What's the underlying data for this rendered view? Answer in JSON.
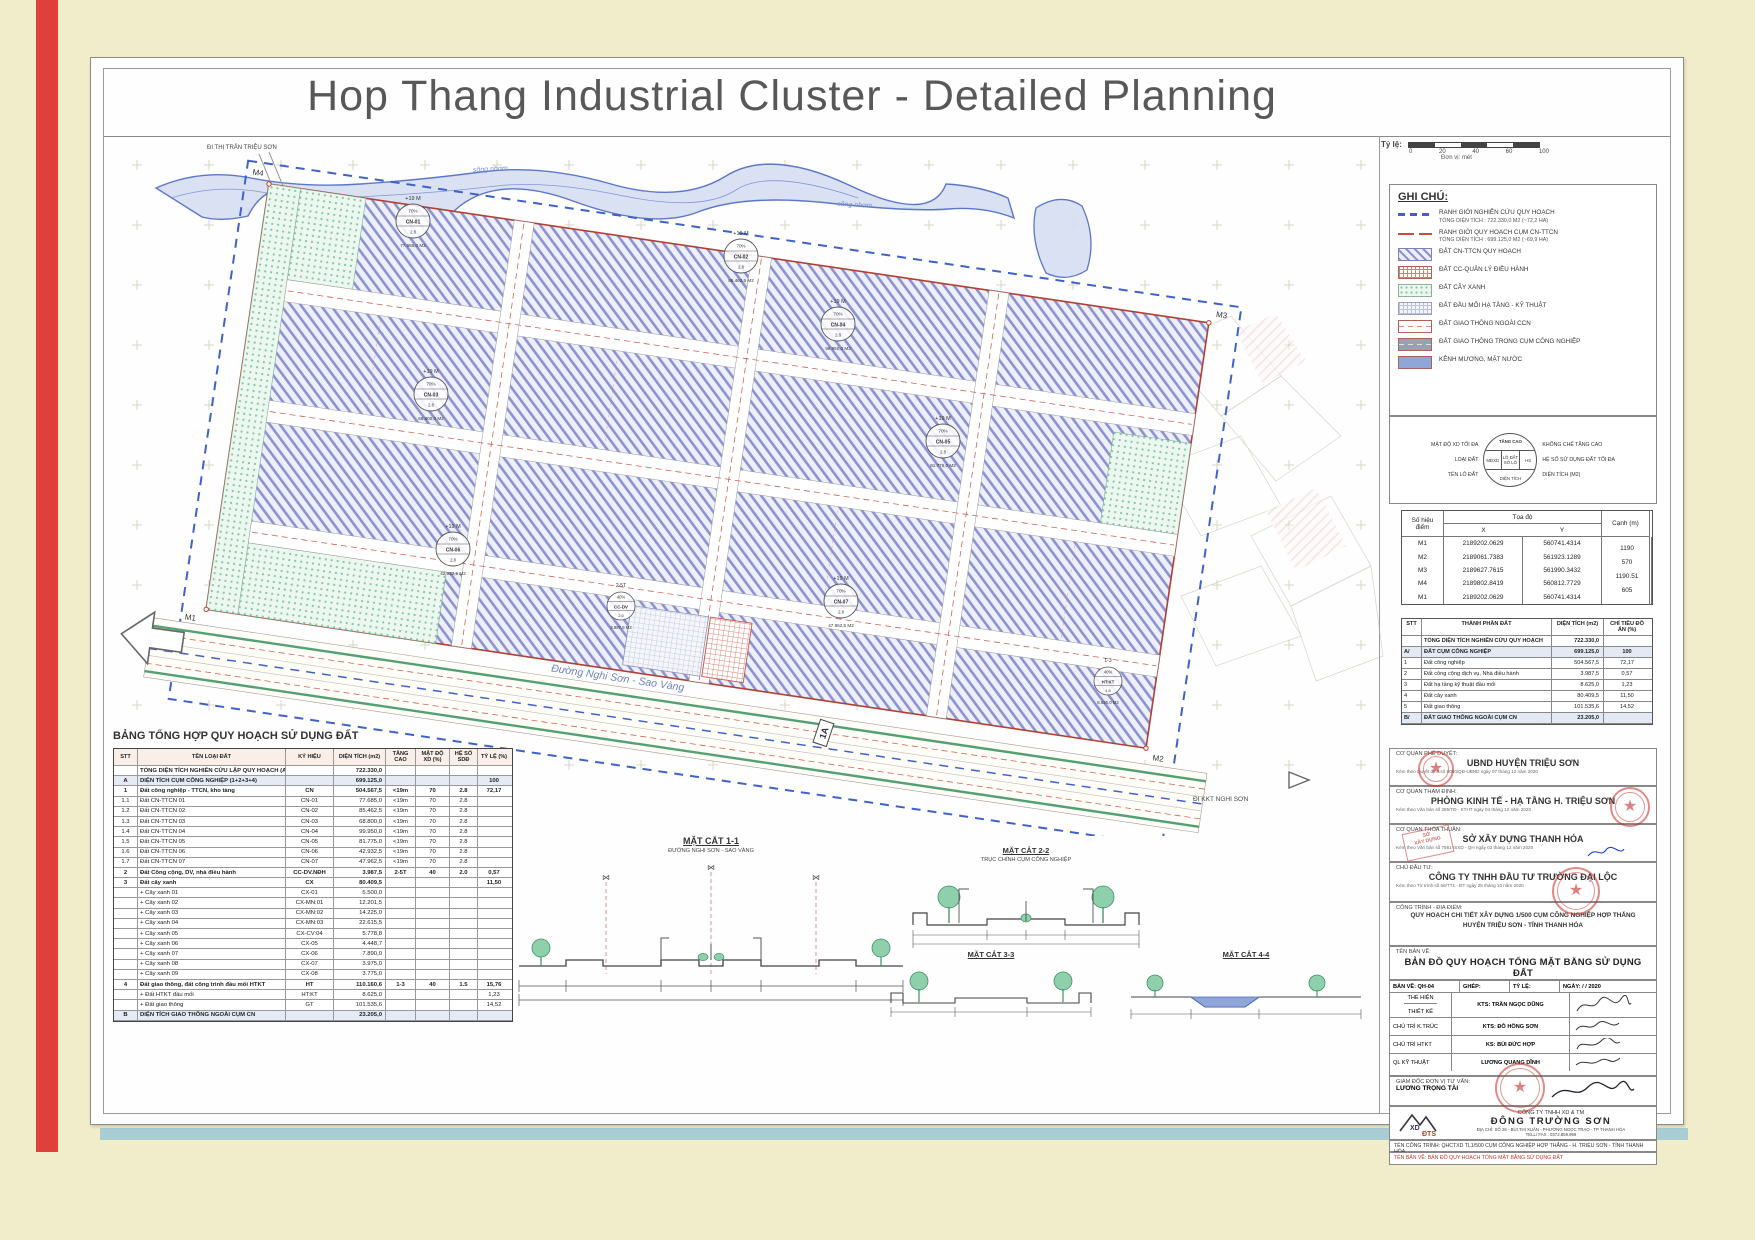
{
  "page": {
    "title": "Hop Thang Industrial Cluster - Detailed Planning"
  },
  "scalebar": {
    "label": "Tỷ lệ:",
    "ticks": [
      "0",
      "20",
      "40",
      "60",
      "100"
    ],
    "unit": "Đơn vị: mét"
  },
  "map": {
    "dir_top_left": "ĐI THỊ TRẤN TRIỆU SƠN",
    "dir_bottom_right": "ĐI KKT NGHI SƠN",
    "river_labels": [
      "sông nhơm",
      "sông nhơm"
    ],
    "road_label": "Đường Nghi Sơn - Sao Vàng",
    "marker_1a": "1A",
    "corners": [
      "M4",
      "M3",
      "M2",
      "M1"
    ],
    "lots": [
      {
        "code": "CN-01",
        "height": "+19 M",
        "density": "70%",
        "far": "2.8",
        "area": "77.685,0 M2"
      },
      {
        "code": "CN-02",
        "height": "+19 M",
        "density": "70%",
        "far": "2.8",
        "area": "85.462,5 M2"
      },
      {
        "code": "CN-03",
        "height": "+19 M",
        "density": "70%",
        "far": "2.8",
        "area": "68.800,0 M2"
      },
      {
        "code": "CN-04",
        "height": "+19 M",
        "density": "70%",
        "far": "2.8",
        "area": "99.950,0 M2"
      },
      {
        "code": "CN-05",
        "height": "+19 M",
        "density": "70%",
        "far": "2.8",
        "area": "81.775,0 M2"
      },
      {
        "code": "CN-06",
        "height": "+19 M",
        "density": "70%",
        "far": "2.8",
        "area": "42.932,5 M2"
      },
      {
        "code": "CN-07",
        "height": "+19 M",
        "density": "70%",
        "far": "2.8",
        "area": "47.962,5 M2"
      },
      {
        "code": "CC-DV",
        "height": "2-5T",
        "density": "40%",
        "far": "2.0",
        "area": "3.987,5 M2"
      },
      {
        "code": "HT:KT",
        "height": "1-3",
        "density": "40%",
        "far": "1.5",
        "area": "8.625,0 M2"
      }
    ]
  },
  "legend": {
    "title": "GHI CHÚ:",
    "items": [
      {
        "swatch": "boundary-blue",
        "label": "RANH GIỚI NGHIÊN CỨU QUY HOẠCH",
        "sub": "TỔNG DIỆN TÍCH :  722.330,0 M2 (~72,2 HA)"
      },
      {
        "swatch": "boundary-red",
        "label": "RANH GIỚI QUY HOẠCH CỤM CN-TTCN",
        "sub": "TỔNG DIỆN TÍCH :  699.125,0 M2 (~69,9 HA)"
      },
      {
        "swatch": "hatch-purple",
        "label": "ĐẤT CN-TTCN QUY HOẠCH",
        "sub": ""
      },
      {
        "swatch": "grid-red",
        "label": "ĐẤT CC-QUẢN LÝ ĐIỀU HÀNH",
        "sub": ""
      },
      {
        "swatch": "dots-green",
        "label": "ĐẤT CÂY XANH",
        "sub": ""
      },
      {
        "swatch": "grid-gray",
        "label": "ĐẤT ĐẦU MỐI HẠ TẦNG - KỸ THUẬT",
        "sub": ""
      },
      {
        "swatch": "road-outer",
        "label": "ĐẤT GIAO THÔNG NGOÀI CCN",
        "sub": ""
      },
      {
        "swatch": "road-inner",
        "label": "ĐẤT GIAO THÔNG TRONG CỤM CÔNG NGHIỆP",
        "sub": ""
      },
      {
        "swatch": "water",
        "label": "KÊNH MƯƠNG, MẶT NƯỚC",
        "sub": ""
      }
    ]
  },
  "symbol_key": {
    "left_labels": [
      "MẬT ĐỘ XD TỐI ĐA",
      "LOẠI ĐẤT",
      "TÊN LÔ ĐẤT"
    ],
    "right_labels": [
      "KHỐNG CHẾ TẦNG CAO",
      "HỆ SỐ SỬ DỤNG ĐẤT TỐI ĐA",
      "DIỆN TÍCH (M2)"
    ],
    "circle": {
      "top": "TẦNG CAO",
      "c1": "MĐXD",
      "c2": "LÔ ĐẤT SỐ LÔ",
      "c3": "HS",
      "bottom": "DIỆN TÍCH"
    }
  },
  "coords_table": {
    "h_point": "Số hiệu điểm",
    "h_coord": "Tọa độ",
    "h_x": "X",
    "h_y": "Y",
    "h_edge": "Cạnh (m)",
    "rows": [
      {
        "p": "M1",
        "x": "2189202.0629",
        "y": "560741.4314"
      },
      {
        "p": "M2",
        "x": "2189061.7383",
        "y": "561923.1289"
      },
      {
        "p": "M3",
        "x": "2189627.7615",
        "y": "561990.3432"
      },
      {
        "p": "M4",
        "x": "2189802.8419",
        "y": "560812.7729"
      },
      {
        "p": "M1",
        "x": "2189202.0629",
        "y": "560741.4314"
      }
    ],
    "edges": [
      "1190",
      "570",
      "1190.51",
      "605"
    ]
  },
  "composition_table": {
    "headers": {
      "stt": "STT",
      "name": "THÀNH PHẦN ĐẤT",
      "area": "DIỆN TÍCH (m2)",
      "ratio": "CHỈ TIÊU ĐỒ ÁN (%)"
    },
    "rows": [
      {
        "stt": "",
        "name": "TỔNG DIỆN TÍCH NGHIÊN CỨU QUY HOẠCH",
        "area": "722.330,0",
        "ratio": "",
        "variant": "total"
      },
      {
        "stt": "A/",
        "name": "ĐẤT CỤM CÔNG NGHIỆP",
        "area": "699.125,0",
        "ratio": "100",
        "variant": "section"
      },
      {
        "stt": "1",
        "name": "Đất công nghiệp",
        "area": "504.567,5",
        "ratio": "72,17",
        "variant": "sub"
      },
      {
        "stt": "2",
        "name": "Đất công cộng dịch vụ, Nhà điều hành",
        "area": "3.987,5",
        "ratio": "0,57",
        "variant": "sub"
      },
      {
        "stt": "3",
        "name": "Đất hạ tầng kỹ thuật đầu mối",
        "area": "8.625,0",
        "ratio": "1,23",
        "variant": "sub"
      },
      {
        "stt": "4",
        "name": "Đất cây xanh",
        "area": "80.409,5",
        "ratio": "11,50",
        "variant": "sub"
      },
      {
        "stt": "5",
        "name": "Đất giao thông",
        "area": "101.535,6",
        "ratio": "14,52",
        "variant": "sub"
      },
      {
        "stt": "B/",
        "name": "ĐẤT GIAO THÔNG NGOÀI CỤM CN",
        "area": "23.205,0",
        "ratio": "",
        "variant": "section"
      }
    ]
  },
  "approvals": [
    {
      "heading": "CƠ QUAN PHÊ DUYỆT:",
      "name": "UBND HUYỆN TRIỆU SƠN",
      "note": "Kèm theo Quyết định số  8050/QĐ-UBND   ngày 07 tháng 12 năm 2020"
    },
    {
      "heading": "CƠ QUAN THẨM ĐỊNH:",
      "name": "PHÒNG KINH TẾ - HẠ TẦNG H. TRIỆU SƠN",
      "note": "Kèm theo Văn bản số  285/TĐ - KTHT    ngày 04 tháng 12 năm 2020"
    },
    {
      "heading": "CƠ QUAN THỎA THUẬN:",
      "name": "SỞ XÂY DỰNG THANH HÓA",
      "note": "Kèm theo Văn bản số  7561 /SXD - QH    ngày 02 tháng 12 năm 2020"
    },
    {
      "heading": "CHỦ ĐẦU TƯ:",
      "name": "CÔNG TY TNHH ĐẦU TƯ TRƯỜNG ĐẠI LỘC",
      "note": "Kèm theo Tờ trình số  68/TT1 - ĐT   ngày 25 tháng 10 năm 2020"
    }
  ],
  "project": {
    "heading": "CÔNG TRÌNH - ĐỊA ĐIỂM:",
    "line1": "QUY HOẠCH CHI TIẾT XÂY DỰNG 1/500 CỤM CÔNG NGHIỆP HỢP THẮNG",
    "line2": "HUYỆN TRIỆU SƠN - TỈNH THANH HÓA",
    "drawing_heading": "TÊN BẢN VẼ:",
    "drawing_name": "BẢN ĐỒ QUY HOẠCH TỔNG MẶT BẰNG SỬ DỤNG ĐẤT"
  },
  "title_block": {
    "c1": "BẢN VẼ: QH-04",
    "c2": "GHÉP:",
    "c3": "TỶ LỆ:",
    "c4": "NGÀY:     /     / 2020",
    "role1a": "THỂ HIỆN",
    "role1b": "THIẾT KẾ",
    "name1": "KTS: TRẦN NGỌC DŨNG",
    "role2": "CHỦ TRÌ K.TRÚC",
    "name2": "KTS: ĐỖ HỒNG SƠN",
    "role3": "CHỦ TRÌ HTKT",
    "name3": "KS: BÙI ĐỨC HỢP",
    "role4": "QL KỸ THUẬT",
    "name4": "LƯƠNG QUANG DĨNH",
    "director_role": "GIÁM ĐỐC ĐƠN VỊ TƯ VẤN:",
    "director_name": "LƯƠNG TRỌNG TÀI"
  },
  "company": {
    "logo_text1": "XD",
    "logo_text2": "ĐTS",
    "line1": "CÔNG TY TNHH XD & TM",
    "name": "ĐÔNG TRƯỜNG SƠN",
    "address": "ĐỊA CHỈ: SỐ 26 - BÙI THỊ XUÂN - PHƯỜNG NGỌC TRẠO - TP THANH HÓA",
    "phone": "TELL/ FAX : 0372.859.959"
  },
  "footer": {
    "line1": "TÊN CÔNG TRÌNH:  QHCTXD TL1/500 CỤM CÔNG NGHIỆP HỢP THẮNG - H. TRIỆU SƠN - TỈNH THANH HÓA",
    "line2": "TÊN BẢN VẼ:  BẢN ĐỒ QUY HOẠCH TỔNG MẶT BẰNG SỬ DỤNG ĐẤT"
  },
  "landuse_table": {
    "title": "BẢNG TỔNG HỢP QUY HOẠCH SỬ DỤNG ĐẤT",
    "headers": {
      "stt": "STT",
      "name": "TÊN LOẠI ĐẤT",
      "sym": "KÝ HIỆU",
      "area": "DIỆN TÍCH (m2)",
      "floors": "TẦNG CAO",
      "density": "MẬT ĐỘ XD (%)",
      "far": "HỆ SỐ SDĐ",
      "ratio": "TỶ LỆ (%)"
    },
    "rows": [
      {
        "stt": "",
        "name": "TỔNG DIỆN TÍCH NGHIÊN CỨU LẬP QUY HOẠCH (A+B)",
        "sym": "",
        "area": "722.330,0",
        "floors": "",
        "density": "",
        "far": "",
        "ratio": "",
        "variant": "total"
      },
      {
        "stt": "A",
        "name": "DIỆN TÍCH CỤM CÔNG NGHIỆP (1+2+3+4)",
        "sym": "",
        "area": "699.125,0",
        "floors": "",
        "density": "",
        "far": "",
        "ratio": "100",
        "variant": "section"
      },
      {
        "stt": "1",
        "name": "Đất công nghiệp - TTCN, kho tàng",
        "sym": "CN",
        "area": "504.567,5",
        "floors": "<19m",
        "density": "70",
        "far": "2.8",
        "ratio": "72,17",
        "variant": "group"
      },
      {
        "stt": "1.1",
        "name": "Đất CN-TTCN  01",
        "sym": "CN-01",
        "area": "77.685,0",
        "floors": "<19m",
        "density": "70",
        "far": "2.8",
        "ratio": "",
        "variant": "sub"
      },
      {
        "stt": "1.2",
        "name": "Đất CN-TTCN  02",
        "sym": "CN-02",
        "area": "85.462,5",
        "floors": "<19m",
        "density": "70",
        "far": "2.8",
        "ratio": "",
        "variant": "sub"
      },
      {
        "stt": "1.3",
        "name": "Đất CN-TTCN  03",
        "sym": "CN-03",
        "area": "68.800,0",
        "floors": "<19m",
        "density": "70",
        "far": "2.8",
        "ratio": "",
        "variant": "sub"
      },
      {
        "stt": "1.4",
        "name": "Đất CN-TTCN  04",
        "sym": "CN-04",
        "area": "99.950,0",
        "floors": "<19m",
        "density": "70",
        "far": "2.8",
        "ratio": "",
        "variant": "sub"
      },
      {
        "stt": "1.5",
        "name": "Đất CN-TTCN  05",
        "sym": "CN-05",
        "area": "81.775,0",
        "floors": "<19m",
        "density": "70",
        "far": "2.8",
        "ratio": "",
        "variant": "sub"
      },
      {
        "stt": "1.6",
        "name": "Đất CN-TTCN  06",
        "sym": "CN-06",
        "area": "42.932,5",
        "floors": "<19m",
        "density": "70",
        "far": "2.8",
        "ratio": "",
        "variant": "sub"
      },
      {
        "stt": "1.7",
        "name": "Đất CN-TTCN  07",
        "sym": "CN-07",
        "area": "47.962,5",
        "floors": "<19m",
        "density": "70",
        "far": "2.8",
        "ratio": "",
        "variant": "sub"
      },
      {
        "stt": "2",
        "name": "Đất Công cộng, DV, nhà điều hành",
        "sym": "CC-DV.NĐH",
        "area": "3.987,5",
        "floors": "2-5T",
        "density": "40",
        "far": "2.0",
        "ratio": "0,57",
        "variant": "group"
      },
      {
        "stt": "3",
        "name": "Đất cây xanh",
        "sym": "CX",
        "area": "80.409,5",
        "floors": "",
        "density": "",
        "far": "",
        "ratio": "11,50",
        "variant": "group"
      },
      {
        "stt": "",
        "name": "+ Cây xanh 01",
        "sym": "CX-01",
        "area": "5.500,0",
        "floors": "",
        "density": "",
        "far": "",
        "ratio": "",
        "variant": "sub"
      },
      {
        "stt": "",
        "name": "+ Cây xanh 02",
        "sym": "CX-MN:01",
        "area": "12.201,5",
        "floors": "",
        "density": "",
        "far": "",
        "ratio": "",
        "variant": "sub"
      },
      {
        "stt": "",
        "name": "+ Cây xanh 03",
        "sym": "CX-MN:02",
        "area": "14.225,0",
        "floors": "",
        "density": "",
        "far": "",
        "ratio": "",
        "variant": "sub"
      },
      {
        "stt": "",
        "name": "+ Cây xanh 04",
        "sym": "CX-MN:03",
        "area": "22.615,5",
        "floors": "",
        "density": "",
        "far": "",
        "ratio": "",
        "variant": "sub"
      },
      {
        "stt": "",
        "name": "+ Cây xanh 05",
        "sym": "CX-CV:04",
        "area": "5.778,8",
        "floors": "",
        "density": "",
        "far": "",
        "ratio": "",
        "variant": "sub"
      },
      {
        "stt": "",
        "name": "+ Cây xanh 06",
        "sym": "CX-05",
        "area": "4.448,7",
        "floors": "",
        "density": "",
        "far": "",
        "ratio": "",
        "variant": "sub"
      },
      {
        "stt": "",
        "name": "+ Cây xanh 07",
        "sym": "CX-06",
        "area": "7.890,0",
        "floors": "",
        "density": "",
        "far": "",
        "ratio": "",
        "variant": "sub"
      },
      {
        "stt": "",
        "name": "+ Cây xanh 08",
        "sym": "CX-07",
        "area": "3.975,0",
        "floors": "",
        "density": "",
        "far": "",
        "ratio": "",
        "variant": "sub"
      },
      {
        "stt": "",
        "name": "+ Cây xanh 09",
        "sym": "CX-08",
        "area": "3.775,0",
        "floors": "",
        "density": "",
        "far": "",
        "ratio": "",
        "variant": "sub"
      },
      {
        "stt": "4",
        "name": "Đất giao thông, đất công trình đầu mối HTKT",
        "sym": "HT",
        "area": "110.160,6",
        "floors": "1-3",
        "density": "40",
        "far": "1.5",
        "ratio": "15,76",
        "variant": "group"
      },
      {
        "stt": "",
        "name": "+ Đất HTKT đầu mối",
        "sym": "HT:KT",
        "area": "8.625,0",
        "floors": "",
        "density": "",
        "far": "",
        "ratio": "1,23",
        "variant": "sub"
      },
      {
        "stt": "",
        "name": "+ Đất giao thông",
        "sym": "GT",
        "area": "101.535,6",
        "floors": "",
        "density": "",
        "far": "",
        "ratio": "14,52",
        "variant": "sub"
      },
      {
        "stt": "B",
        "name": "DIỆN TÍCH GIAO THÔNG NGOÀI CỤM CN",
        "sym": "",
        "area": "23.205,0",
        "floors": "",
        "density": "",
        "far": "",
        "ratio": "",
        "variant": "section"
      }
    ]
  },
  "sections": [
    {
      "title": "MẶT CẮT 1-1",
      "subtitle": "ĐƯỜNG NGHI SƠN - SAO VÀNG"
    },
    {
      "title": "MẶT CẮT 2-2",
      "subtitle": "TRỤC CHÍNH CỤM CÔNG NGHIỆP"
    },
    {
      "title": "MẶT CẮT 3-3",
      "subtitle": ""
    },
    {
      "title": "MẶT CẮT 4-4",
      "subtitle": ""
    }
  ]
}
